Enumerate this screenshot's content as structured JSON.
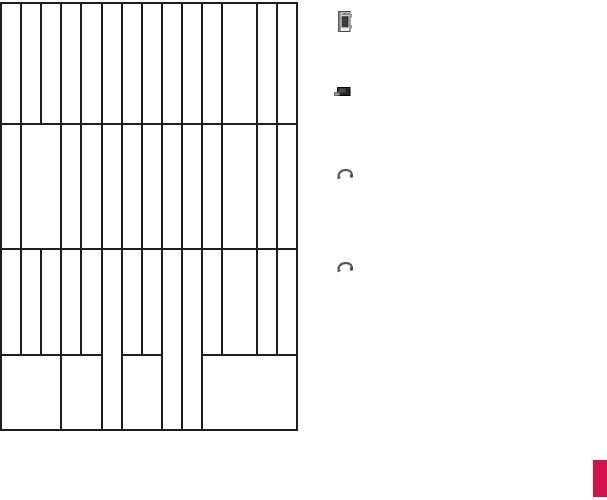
{
  "canvas": {
    "width": 607,
    "height": 500,
    "background": "#ffffff"
  },
  "grid": {
    "stroke_color": "#1f1f1f",
    "stroke_width": 2,
    "bounds": {
      "left": 1,
      "top": 3,
      "right": 297,
      "bottom": 430
    },
    "row_boundaries": [
      3,
      124,
      249,
      355,
      430
    ],
    "cells": [
      [
        1,
        3,
        20,
        121
      ],
      [
        21,
        3,
        20,
        121
      ],
      [
        41,
        3,
        20,
        121
      ],
      [
        61,
        3,
        20,
        121
      ],
      [
        81,
        3,
        21,
        121
      ],
      [
        102,
        3,
        20,
        121
      ],
      [
        122,
        3,
        20,
        121
      ],
      [
        142,
        3,
        20,
        121
      ],
      [
        162,
        3,
        20,
        121
      ],
      [
        182,
        3,
        20,
        121
      ],
      [
        202,
        3,
        20,
        121
      ],
      [
        222,
        3,
        35,
        121
      ],
      [
        257,
        3,
        20,
        121
      ],
      [
        277,
        3,
        20,
        121
      ],
      [
        1,
        124,
        20,
        125
      ],
      [
        21,
        124,
        40,
        125
      ],
      [
        61,
        124,
        20,
        125
      ],
      [
        81,
        124,
        21,
        125
      ],
      [
        102,
        124,
        20,
        125
      ],
      [
        122,
        124,
        20,
        125
      ],
      [
        142,
        124,
        20,
        125
      ],
      [
        162,
        124,
        20,
        125
      ],
      [
        182,
        124,
        20,
        125
      ],
      [
        202,
        124,
        20,
        125
      ],
      [
        222,
        124,
        35,
        125
      ],
      [
        257,
        124,
        20,
        125
      ],
      [
        277,
        124,
        20,
        125
      ],
      [
        1,
        249,
        20,
        106
      ],
      [
        21,
        249,
        20,
        106
      ],
      [
        41,
        249,
        20,
        106
      ],
      [
        61,
        249,
        20,
        106
      ],
      [
        81,
        249,
        21,
        106
      ],
      [
        122,
        249,
        20,
        106
      ],
      [
        142,
        249,
        20,
        106
      ],
      [
        202,
        249,
        20,
        106
      ],
      [
        222,
        249,
        35,
        106
      ],
      [
        257,
        249,
        20,
        106
      ],
      [
        277,
        249,
        20,
        106
      ],
      [
        102,
        249,
        20,
        181
      ],
      [
        162,
        249,
        20,
        181
      ],
      [
        182,
        249,
        20,
        181
      ],
      [
        1,
        355,
        60,
        75
      ],
      [
        61,
        355,
        41,
        75
      ],
      [
        122,
        355,
        40,
        75
      ],
      [
        202,
        355,
        95,
        75
      ]
    ]
  },
  "icons": [
    {
      "name": "handheld-device-icon",
      "x": 337,
      "y": 11,
      "width": 15,
      "height": 21
    },
    {
      "name": "battery-icon",
      "x": 334,
      "y": 86,
      "width": 17,
      "height": 12
    },
    {
      "name": "swoosh-arrow-icon",
      "x": 337,
      "y": 166,
      "width": 16,
      "height": 14
    },
    {
      "name": "swoosh-arrow-icon",
      "x": 337,
      "y": 259,
      "width": 16,
      "height": 14
    }
  ],
  "accent_rect": {
    "x": 593,
    "y": 460,
    "width": 14,
    "height": 37,
    "color": "#D2124B"
  }
}
